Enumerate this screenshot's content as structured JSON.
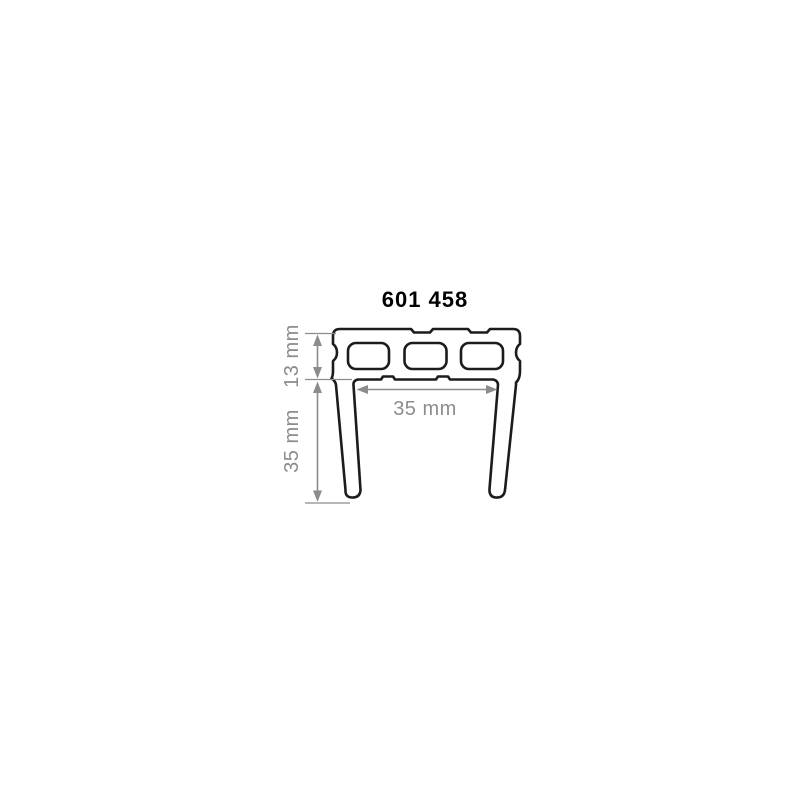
{
  "drawing": {
    "part_number": "601 458",
    "dimensions": {
      "top_bar_height": "13 mm",
      "leg_length": "35 mm",
      "inner_width": "35 mm"
    },
    "colors": {
      "outline": "#1c1c1c",
      "dimension_gray": "#8c8c8c",
      "title": "#000000",
      "background": "#ffffff"
    }
  }
}
